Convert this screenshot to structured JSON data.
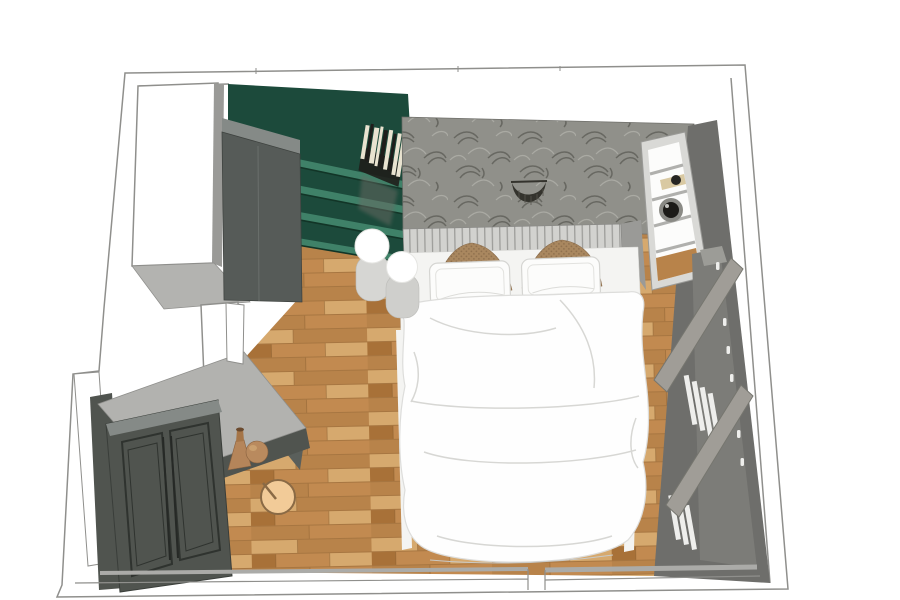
{
  "scene": {
    "type": "3d-room-render",
    "room": "bedroom",
    "view": "top-down-perspective"
  },
  "items": [
    "room-wall-outline",
    "parquet-floor",
    "window-opening-top-left",
    "window-opening-left",
    "green-bookshelf",
    "books-row",
    "tall-wardrobe",
    "wallpaper-accent-wall",
    "crescent-wall-decor",
    "slatted-headboard",
    "double-bed",
    "brown-knit-pillows",
    "white-pillows",
    "white-duvet",
    "bedside-stool-lamps",
    "white-shelf-unit",
    "round-speaker",
    "right-wall-wardrobe",
    "sideboard",
    "double-door-wardrobe",
    "decor-vases",
    "round-pouf"
  ],
  "colors": {
    "background": "#ffffff",
    "wall_line": "#8f8f8c",
    "wall_face_light": "#b3b3b0",
    "wall_face_mid": "#9a9a97",
    "wall_face_dark": "#6e6e6b",
    "floor_wood_base": "#c28a50",
    "floor_wood_light": "#d6a96e",
    "floor_wood_mid": "#b8834a",
    "floor_wood_dark": "#a87138",
    "floor_seam": "#7a5226",
    "green_dark": "#1c4a3b",
    "green_shelf": "#3f8168",
    "green_shelf_shadow": "#123527",
    "wallpaper_base": "#90908a",
    "wallpaper_leaf_dark": "#5e5e57",
    "wallpaper_leaf_light": "#b5b5ae",
    "crescent": "#34332d",
    "headboard": "#d2d2cf",
    "headboard_slat": "#9b9b98",
    "bed_frame": "#f4f4f2",
    "duvet": "#fefefe",
    "duvet_fold": "#d7d7d4",
    "pillow_white": "#fcfcfb",
    "pillow_white_edge": "#d5d5d2",
    "pillow_brown": "#a9875f",
    "pillow_brown_dark": "#7c5f41",
    "stool_gray": "#d6d6d3",
    "stool_gray2": "#cfcfcc",
    "sphere_white": "#ffffff",
    "sphere_edge": "#e6e6e3",
    "wardrobe_dark": "#565b58",
    "wardrobe_top": "#858a87",
    "cabinet_front_dark": "#5a5f5b",
    "cabinet_top_light": "#b2b2af",
    "door_dark": "#50544f",
    "door_panel_line": "#2f332f",
    "door_handle": "#262926",
    "shelf_unit_frame": "#d9d9d6",
    "shelf_unit_white": "#fcfcfb",
    "shelf_divider": "#b0b0ad",
    "book_tan": "#d9c9a2",
    "book_dark": "#262522",
    "speaker_ring": "#8a8a85",
    "speaker_dark": "#1c1b18",
    "radiator_board": "#a09d97",
    "radiator_board_edge": "#76766f",
    "radiator_base": "#7c7c78",
    "radiator_slat_white": "#eeeeec",
    "vase_tan": "#b5855a",
    "vase_neck": "#a57548",
    "jar_tan": "#b98a5e",
    "pouf": "#f2cb98",
    "pouf_line": "#8a6a45",
    "books_cream": "#e9e3d0",
    "books_black": "#1f1e1b",
    "reflection_gray": "#6a6a64"
  }
}
